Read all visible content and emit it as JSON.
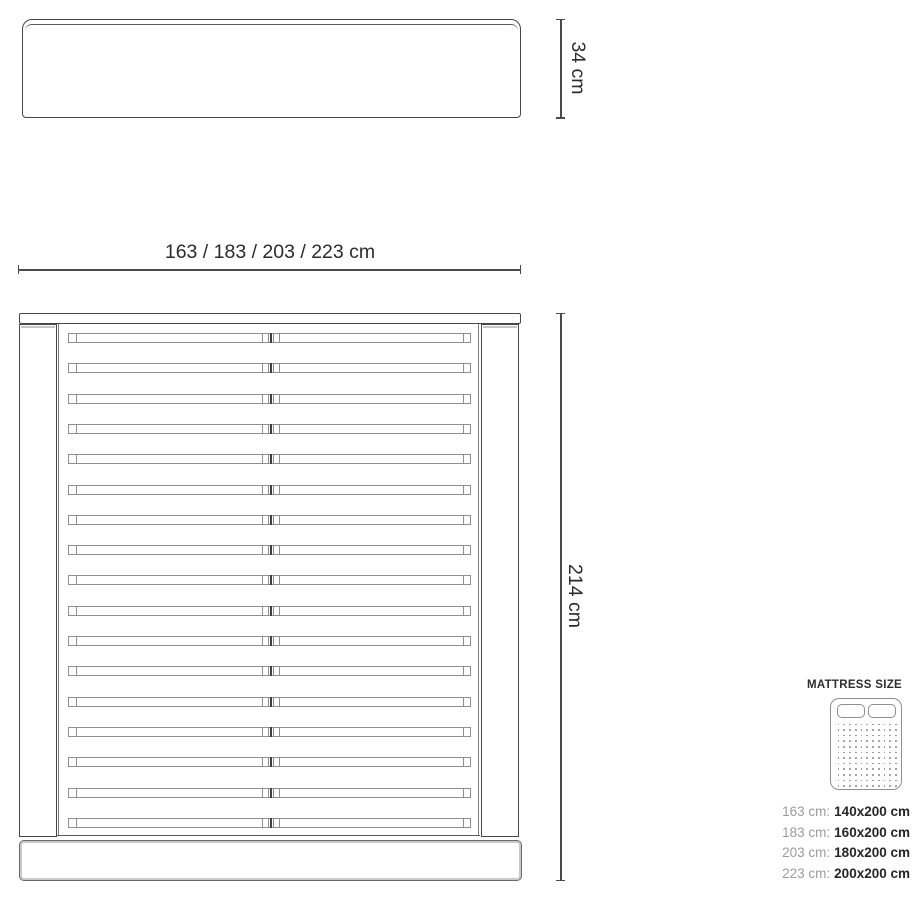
{
  "headboard_view": {
    "height_label": "34 cm"
  },
  "top_view": {
    "width_label": "163 / 183 / 203 / 223 cm",
    "length_label": "214 cm",
    "slat_count": 17
  },
  "mattress_legend": {
    "title": "MATTRESS SIZE",
    "rows": [
      {
        "frame": "163 cm:",
        "mattress": "140x200 cm"
      },
      {
        "frame": "183 cm:",
        "mattress": "160x200 cm"
      },
      {
        "frame": "203 cm:",
        "mattress": "180x200 cm"
      },
      {
        "frame": "223 cm:",
        "mattress": "200x200 cm"
      }
    ]
  },
  "colors": {
    "line_dark": "#474747",
    "line_mid": "#8f8f8f",
    "line_light": "#c9c9c9",
    "text_dark": "#2b2b2b",
    "text_grey": "#9b9b9b"
  }
}
